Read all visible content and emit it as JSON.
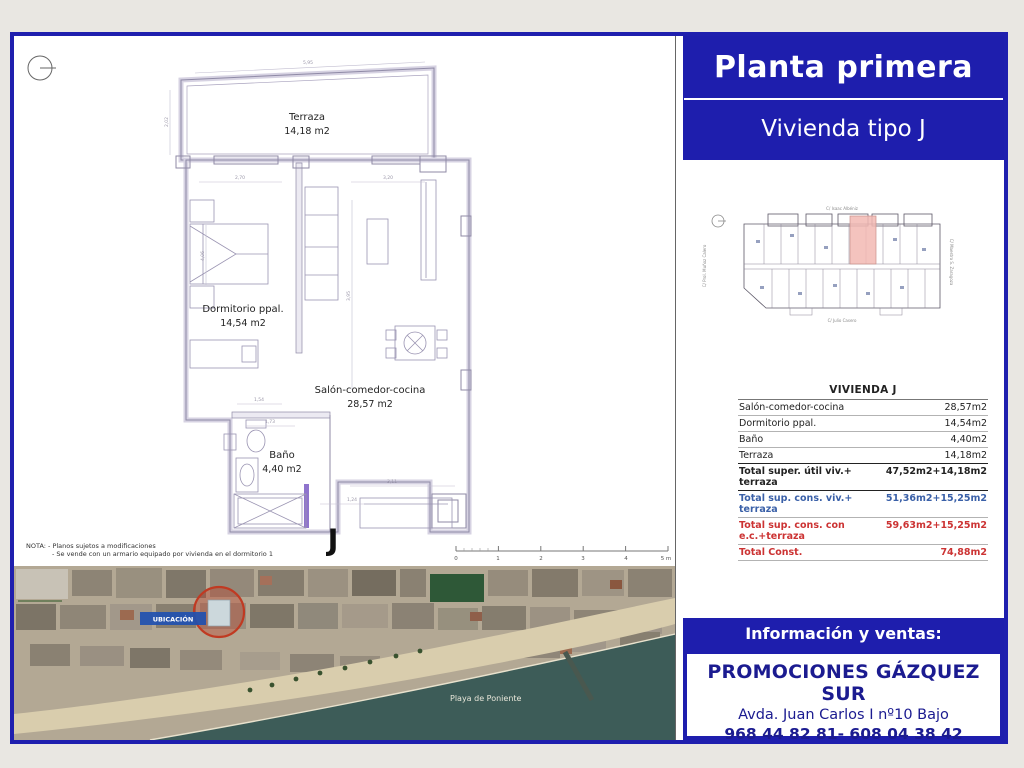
{
  "header": {
    "title": "Planta primera",
    "subtitle": "Vivienda tipo J"
  },
  "floor_plan": {
    "rooms": {
      "terraza": {
        "name": "Terraza",
        "area": "14,18 m2"
      },
      "dormitorio": {
        "name": "Dormitorio ppal.",
        "area": "14,54 m2"
      },
      "salon": {
        "name": "Salón-comedor-cocina",
        "area": "28,57 m2"
      },
      "bano": {
        "name": "Baño",
        "area": "4,40 m2"
      }
    },
    "unit_letter": "J",
    "dims": [
      "5,95",
      "2,70",
      "3,20",
      "2,02",
      "4,06",
      "3,95",
      "1,54",
      "1,73",
      "3,11",
      "1,24"
    ],
    "scale_labels": [
      "0",
      "1",
      "2",
      "3",
      "4",
      "5 m"
    ],
    "notes": {
      "line1": "NOTA: - Planos sujetos a modificaciones",
      "line2": "- Se vende con un armario equipado por vivienda en el dormitorio 1"
    }
  },
  "key_plan": {
    "streets": {
      "top": "C/ Isaac Albéniz",
      "bottom": "C/ Julio Casero",
      "left": "C/ Prol. Muñoz Calero",
      "right": "C/ Maestro S. Zaragoza"
    }
  },
  "table": {
    "title": "VIVIENDA J",
    "rows": [
      {
        "label": "Salón-comedor-cocina",
        "value": "28,57m2"
      },
      {
        "label": "Dormitorio ppal.",
        "value": "14,54m2"
      },
      {
        "label": "Baño",
        "value": "4,40m2"
      },
      {
        "label": "Terraza",
        "value": "14,18m2"
      },
      {
        "label": "Total super. útil viv.+ terraza",
        "value": "47,52m2+14,18m2"
      },
      {
        "label": "Total sup. cons. viv.+ terraza",
        "value": "51,36m2+15,25m2"
      },
      {
        "label": "Total sup. cons. con e.c.+terraza",
        "value": "59,63m2+15,25m2"
      },
      {
        "label": "Total Const.",
        "value": "74,88m2"
      }
    ]
  },
  "map": {
    "location_label": "UBICACIÓN",
    "beach_label": "Playa de Poniente"
  },
  "sales": {
    "bar_label": "Información y ventas:",
    "company": "PROMOCIONES GÁZQUEZ SUR",
    "address": "Avda. Juan Carlos I nº10 Bajo",
    "phones": "968 44 82 81- 608 04 38 42"
  },
  "colors": {
    "brand_blue": "#1e1ead",
    "navy_text": "#1b1b90",
    "table_blue": "#3a60a8",
    "table_red": "#cc3333",
    "highlight_pink": "#f2b9b3",
    "location_red": "#c03a22",
    "sea": "#3d5c58",
    "sand": "#d9cdad"
  }
}
